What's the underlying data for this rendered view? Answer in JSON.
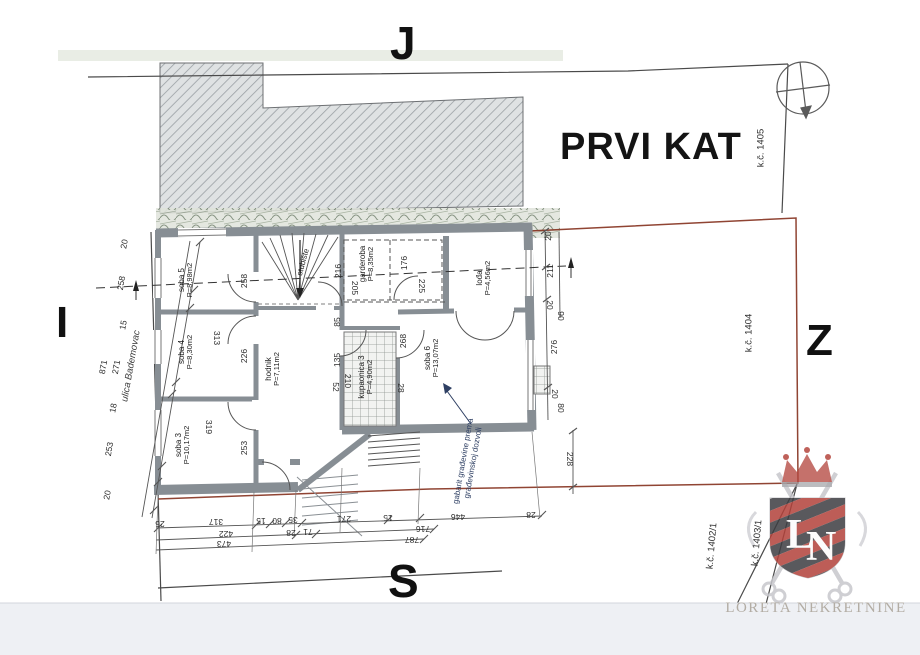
{
  "title": "PRVI KAT",
  "compass": {
    "top": "J",
    "left": "I",
    "right": "Z",
    "bottom": "S"
  },
  "street_label": "ulica Bademovac",
  "annotation": {
    "line1": "gabarit građevine prema",
    "line2": "građevinskoj dozvoli"
  },
  "brand": {
    "name": "LORETA NEKRETNINE",
    "monogram": "LN"
  },
  "parcel_labels": [
    {
      "text": "k.č. 1405",
      "x": 761,
      "y": 148,
      "r": -90
    },
    {
      "text": "k.č. 1404",
      "x": 749,
      "y": 333,
      "r": -90
    },
    {
      "text": "k.č. 1402/1",
      "x": 712,
      "y": 546,
      "r": -85
    },
    {
      "text": "k.č. 1403/1",
      "x": 757,
      "y": 543,
      "r": -85
    }
  ],
  "rooms": [
    {
      "name": "soba 5",
      "area": "P=8,98m2",
      "x": 186,
      "y": 280,
      "r": -90
    },
    {
      "name": "soba 4",
      "area": "P=8,30m2",
      "x": 186,
      "y": 352,
      "r": -90
    },
    {
      "name": "soba 3",
      "area": "P=10,17m2",
      "x": 183,
      "y": 445,
      "r": -90
    },
    {
      "name": "hodnik",
      "area": "P=7,11m2",
      "x": 273,
      "y": 369,
      "r": -90
    },
    {
      "name": "kupaonica 3",
      "area": "P=4,90m2",
      "x": 366,
      "y": 377,
      "r": -90
    },
    {
      "name": "soba 6",
      "area": "P=13,07m2",
      "x": 432,
      "y": 358,
      "r": -90
    },
    {
      "name": "garderoba",
      "area": "P=8,35m2",
      "x": 367,
      "y": 264,
      "r": -90
    },
    {
      "name": "lođa",
      "area": "P=4,56m2",
      "x": 484,
      "y": 278,
      "r": -90
    },
    {
      "name": "stubište",
      "area": "",
      "x": 303,
      "y": 262,
      "r": -75
    }
  ],
  "dimensions": [
    {
      "t": "20",
      "x": 124,
      "y": 244,
      "r": -80
    },
    {
      "t": "258",
      "x": 121,
      "y": 283,
      "r": -80
    },
    {
      "t": "15",
      "x": 123,
      "y": 325,
      "r": -80
    },
    {
      "t": "271",
      "x": 116,
      "y": 367,
      "r": -80
    },
    {
      "t": "871",
      "x": 103,
      "y": 367,
      "r": -80
    },
    {
      "t": "18",
      "x": 113,
      "y": 408,
      "r": -80
    },
    {
      "t": "253",
      "x": 109,
      "y": 449,
      "r": -80
    },
    {
      "t": "20",
      "x": 107,
      "y": 495,
      "r": -80
    },
    {
      "t": "258",
      "x": 244,
      "y": 281,
      "r": -90
    },
    {
      "t": "216",
      "x": 338,
      "y": 271,
      "r": -90
    },
    {
      "t": "176",
      "x": 404,
      "y": 263,
      "r": -90
    },
    {
      "t": "211",
      "x": 550,
      "y": 271,
      "r": -90
    },
    {
      "t": "20",
      "x": 548,
      "y": 236,
      "r": -90
    },
    {
      "t": "276",
      "x": 554,
      "y": 347,
      "r": -90
    },
    {
      "t": "226",
      "x": 244,
      "y": 356,
      "r": -90
    },
    {
      "t": "85",
      "x": 337,
      "y": 322,
      "r": -90
    },
    {
      "t": "268",
      "x": 403,
      "y": 341,
      "r": -90
    },
    {
      "t": "253",
      "x": 244,
      "y": 448,
      "r": -90
    },
    {
      "t": "135",
      "x": 337,
      "y": 360,
      "r": -90
    },
    {
      "t": "205",
      "x": 355,
      "y": 288,
      "r": 90
    },
    {
      "t": "225",
      "x": 422,
      "y": 286,
      "r": 90
    },
    {
      "t": "313",
      "x": 217,
      "y": 338,
      "r": 90
    },
    {
      "t": "319",
      "x": 209,
      "y": 427,
      "r": 90
    },
    {
      "t": "52",
      "x": 336,
      "y": 387,
      "r": 90
    },
    {
      "t": "210",
      "x": 348,
      "y": 381,
      "r": 90
    },
    {
      "t": "28",
      "x": 401,
      "y": 388,
      "r": 90
    },
    {
      "t": "20",
      "x": 550,
      "y": 305,
      "r": 90
    },
    {
      "t": "90",
      "x": 561,
      "y": 316,
      "r": 90
    },
    {
      "t": "20",
      "x": 555,
      "y": 394,
      "r": 90
    },
    {
      "t": "80",
      "x": 561,
      "y": 408,
      "r": 90
    },
    {
      "t": "228",
      "x": 570,
      "y": 459,
      "r": 90
    },
    {
      "t": "26",
      "x": 160,
      "y": 524,
      "r": 180
    },
    {
      "t": "317",
      "x": 216,
      "y": 522,
      "r": 180
    },
    {
      "t": "15",
      "x": 261,
      "y": 521,
      "r": 180
    },
    {
      "t": "80",
      "x": 277,
      "y": 521,
      "r": 180
    },
    {
      "t": "35",
      "x": 293,
      "y": 520,
      "r": 180
    },
    {
      "t": "271",
      "x": 344,
      "y": 519,
      "r": 180
    },
    {
      "t": "15",
      "x": 388,
      "y": 518,
      "r": 180
    },
    {
      "t": "446",
      "x": 458,
      "y": 517,
      "r": 180
    },
    {
      "t": "28",
      "x": 531,
      "y": 515,
      "r": 180
    },
    {
      "t": "422",
      "x": 226,
      "y": 534,
      "r": 180
    },
    {
      "t": "28",
      "x": 291,
      "y": 533,
      "r": 180
    },
    {
      "t": "71",
      "x": 308,
      "y": 532,
      "r": 180
    },
    {
      "t": "716",
      "x": 423,
      "y": 529,
      "r": 180
    },
    {
      "t": "473",
      "x": 224,
      "y": 544,
      "r": 180
    },
    {
      "t": "787",
      "x": 412,
      "y": 540,
      "r": 180
    }
  ],
  "colors": {
    "boundary_red": "#8a3a28",
    "annotation_blue": "#2e3f63",
    "wall_gray": "#878e94",
    "shield_red": "#b2413a",
    "shield_dark": "#3d3d41",
    "brand_text": "#b3ada4"
  }
}
